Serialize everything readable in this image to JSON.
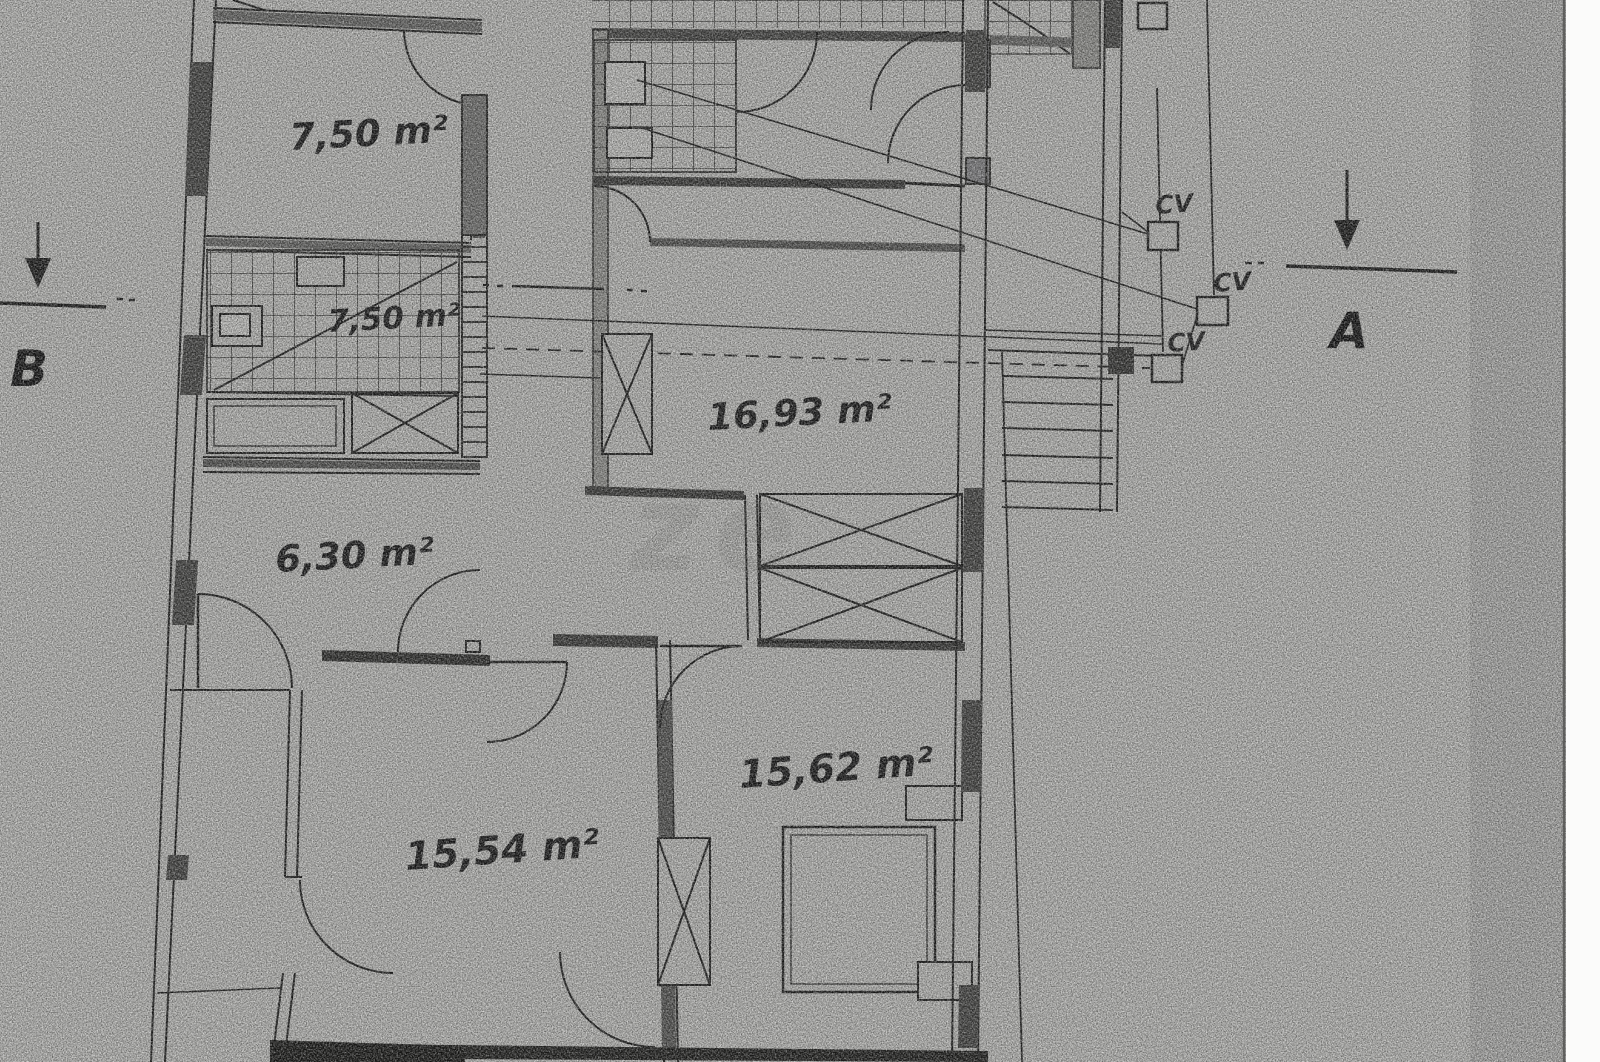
{
  "drawing": {
    "kind": "scanned floor plan",
    "rooms": [
      {
        "id": "room-top-left",
        "label": "7,50 m²"
      },
      {
        "id": "room-bath-tiled",
        "label": "7,50 m²"
      },
      {
        "id": "room-living",
        "label": "16,93 m²"
      },
      {
        "id": "room-hall",
        "label": "6,30 m²"
      },
      {
        "id": "room-bottom-left",
        "label": "15,54 m²"
      },
      {
        "id": "room-bedroom",
        "label": "15,62 m²"
      }
    ],
    "cv": [
      {
        "label": "CV"
      },
      {
        "label": "CV"
      },
      {
        "label": "CV"
      }
    ],
    "sections": {
      "a": "A",
      "b": "B"
    },
    "watermark": "ze",
    "colors": {
      "paper": "#c8c8c5",
      "ink": "#1f1f1e",
      "wall_fill_dark": "#3f3f3d",
      "wall_fill_mid": "#777775",
      "right_strip_white": "#fbfbfa"
    }
  }
}
